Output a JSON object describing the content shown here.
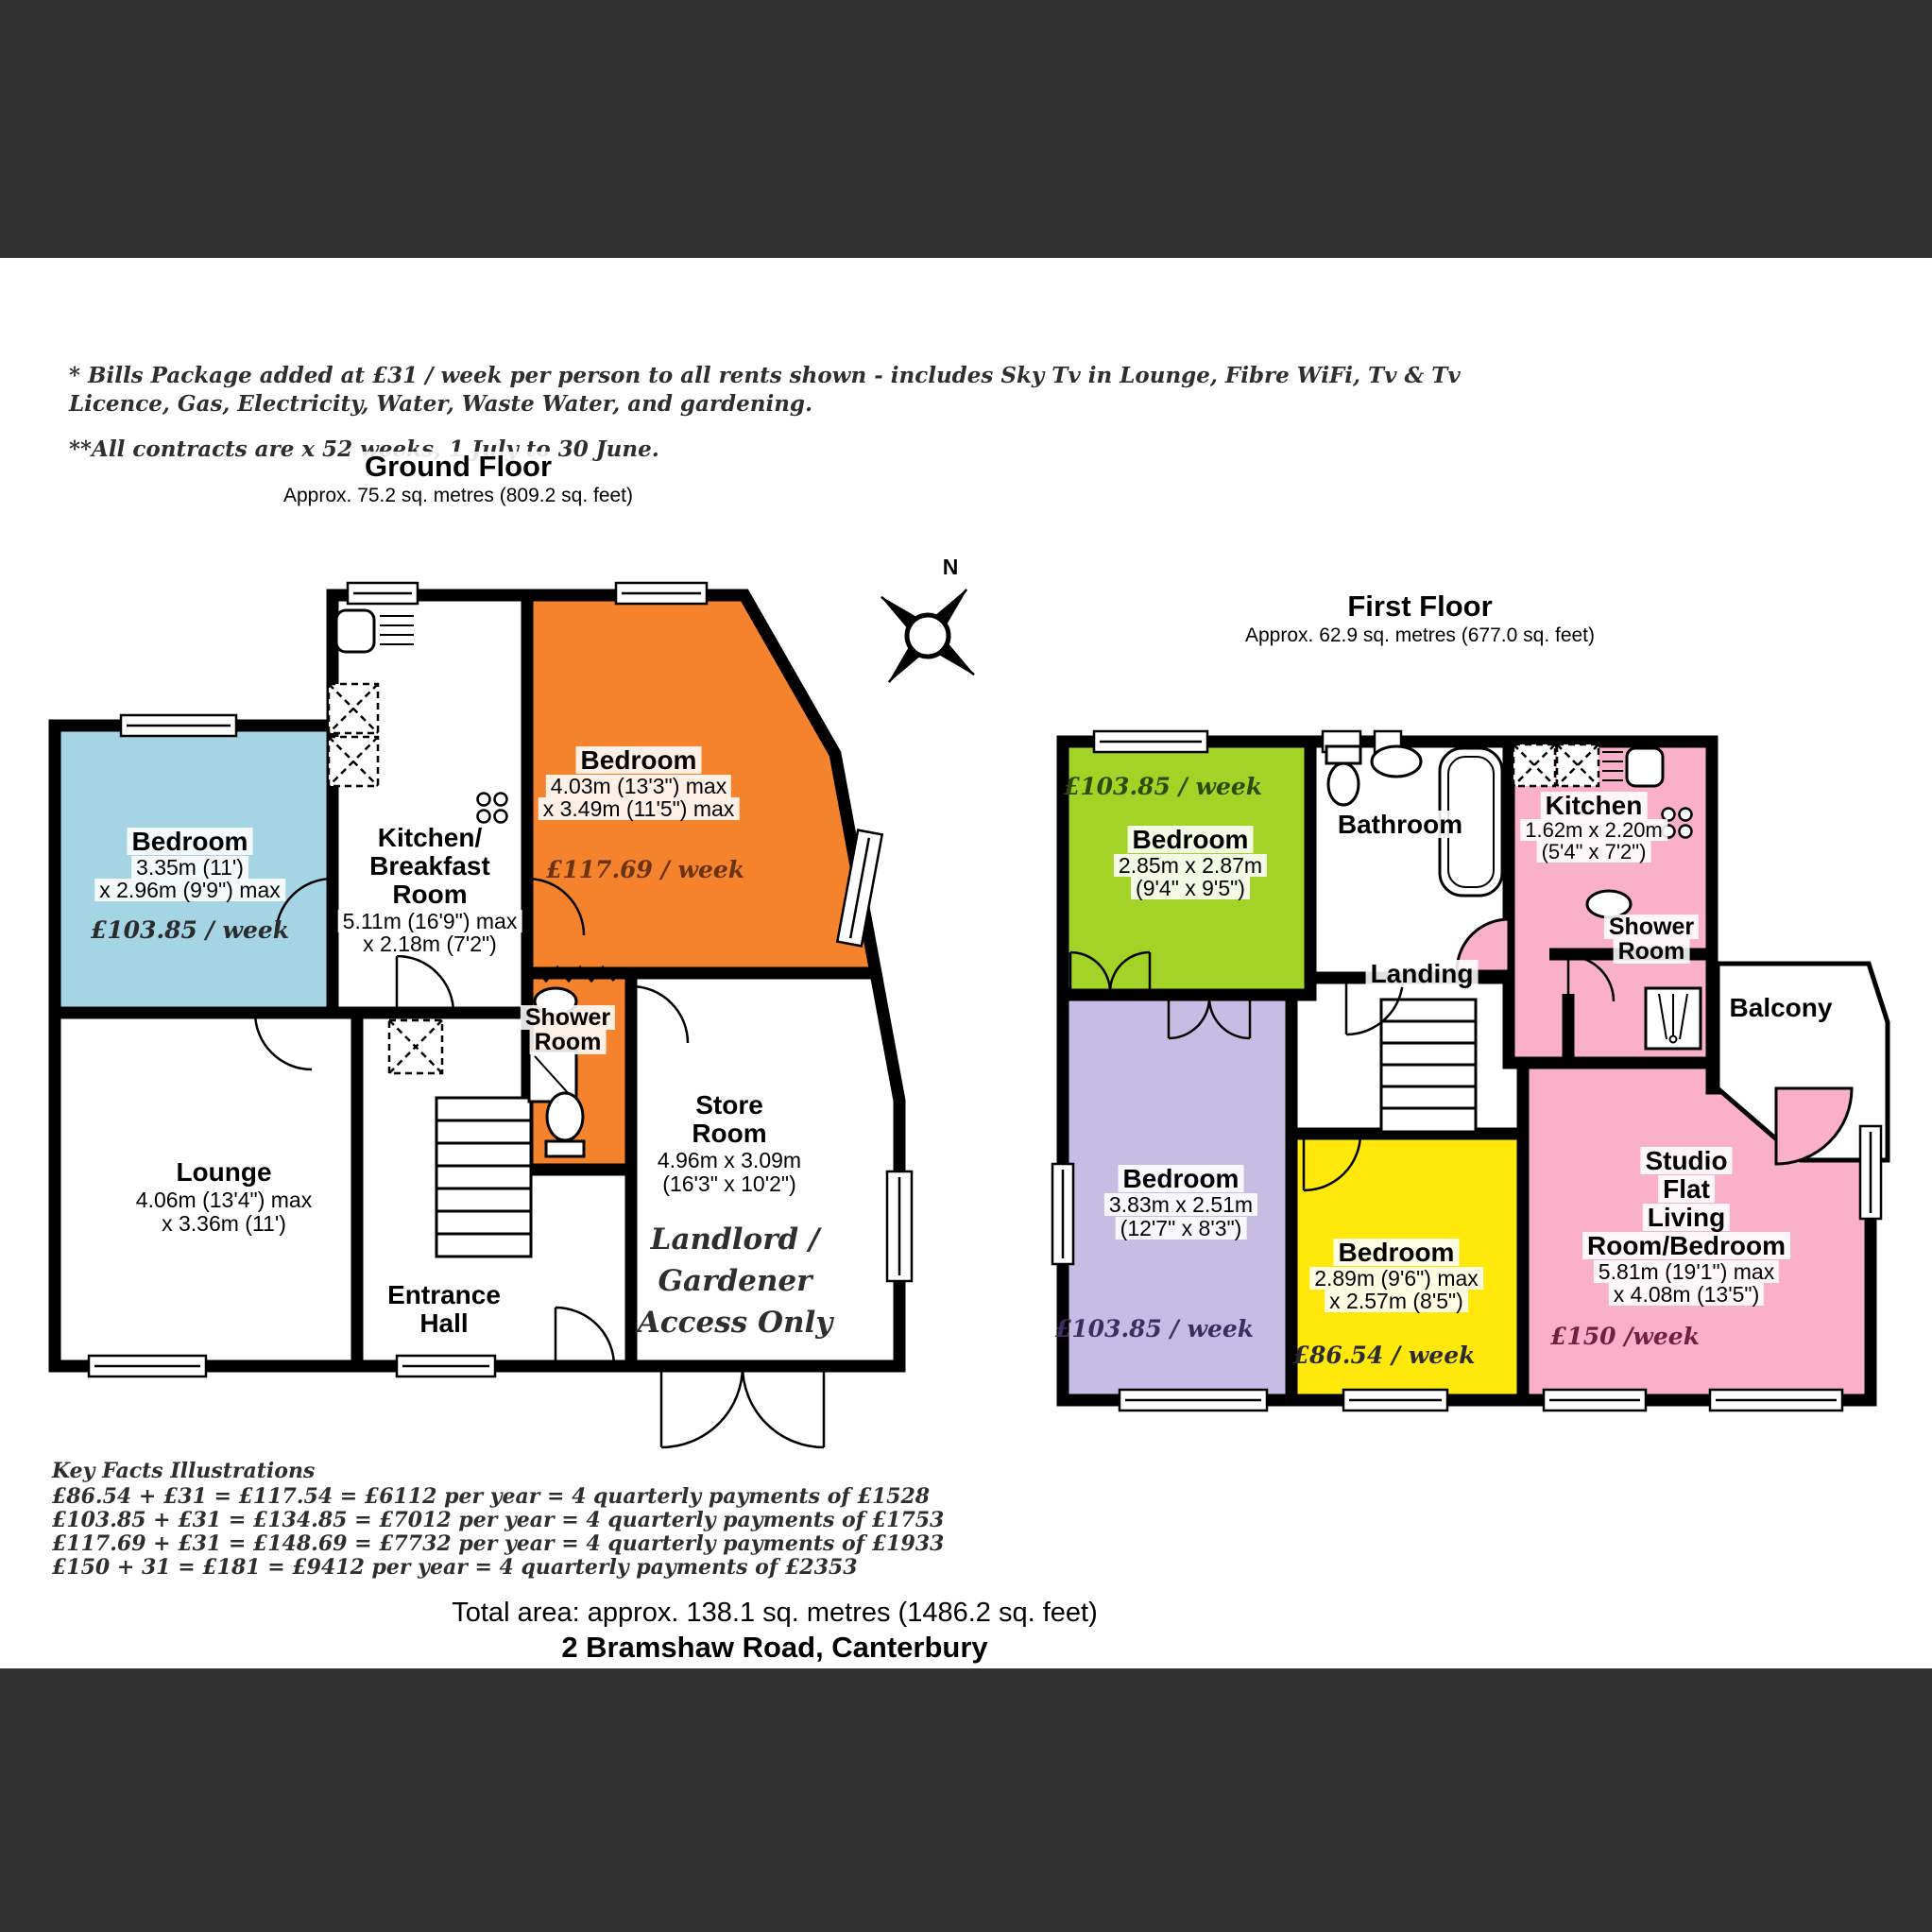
{
  "header": {
    "note1": "* Bills Package added at £31 / week per person to all rents shown - includes Sky Tv in Lounge, Fibre WiFi, Tv & Tv",
    "note2": "Licence, Gas, Electricity, Water, Waste Water, and gardening.",
    "note3": "**All contracts are x 52 weeks, 1 July to 30 June."
  },
  "compass": {
    "north_label": "N"
  },
  "ground_floor": {
    "title": "Ground Floor",
    "subtitle": "Approx. 75.2 sq. metres (809.2 sq. feet)",
    "rooms": {
      "bedroom_front": {
        "name": "Bedroom",
        "dim1": "3.35m (11')",
        "dim2": "x 2.96m (9'9\") max",
        "price": "£103.85 / week"
      },
      "kitchen": {
        "name1": "Kitchen/",
        "name2": "Breakfast",
        "name3": "Room",
        "dim1": "5.11m (16'9\") max",
        "dim2": "x 2.18m (7'2\")"
      },
      "bedroom_rear": {
        "name": "Bedroom",
        "dim1": "4.03m (13'3\") max",
        "dim2": "x 3.49m (11'5\") max",
        "price": "£117.69 / week"
      },
      "shower_room": {
        "name1": "Shower",
        "name2": "Room"
      },
      "store_room": {
        "name1": "Store",
        "name2": "Room",
        "dim1": "4.96m x 3.09m",
        "dim2": "(16'3\" x 10'2\")",
        "note1": "Landlord /",
        "note2": "Gardener",
        "note3": "Access Only"
      },
      "lounge": {
        "name": "Lounge",
        "dim1": "4.06m (13'4\") max",
        "dim2": "x 3.36m (11')"
      },
      "entrance_hall": {
        "name1": "Entrance",
        "name2": "Hall"
      }
    }
  },
  "first_floor": {
    "title": "First Floor",
    "subtitle": "Approx. 62.9 sq. metres (677.0 sq. feet)",
    "rooms": {
      "bedroom_green": {
        "price": "£103.85 / week",
        "name": "Bedroom",
        "dim1": "2.85m x 2.87m",
        "dim2": "(9'4\" x 9'5\")"
      },
      "bathroom": {
        "name": "Bathroom"
      },
      "kitchen": {
        "name": "Kitchen",
        "dim1": "1.62m x 2.20m",
        "dim2": "(5'4\" x 7'2\")"
      },
      "shower_room": {
        "name1": "Shower",
        "name2": "Room"
      },
      "balcony": {
        "name": "Balcony"
      },
      "landing": {
        "name": "Landing"
      },
      "bedroom_purple": {
        "name": "Bedroom",
        "dim1": "3.83m x 2.51m",
        "dim2": "(12'7\" x 8'3\")",
        "price": "£103.85 / week"
      },
      "bedroom_yellow": {
        "name": "Bedroom",
        "dim1": "2.89m (9'6\") max",
        "dim2": "x 2.57m (8'5\")",
        "price": "£86.54 / week"
      },
      "studio": {
        "name1": "Studio",
        "name2": "Flat",
        "name3": "Living",
        "name4": "Room/Bedroom",
        "dim1": "5.81m (19'1\") max",
        "dim2": "x 4.08m (13'5\")",
        "price": "£150 /week"
      }
    }
  },
  "key_facts": {
    "title": "Key Facts Illustrations",
    "lines": [
      "£86.54 + £31 = £117.54 = £6112 per year = 4 quarterly payments of £1528",
      "£103.85 + £31 = £134.85 = £7012 per year = 4 quarterly payments of £1753",
      "£117.69 + £31 = £148.69 = £7732 per year = 4 quarterly payments of £1933",
      "£150 + 31 = £181 = £9412 per year = 4 quarterly payments of £2353"
    ]
  },
  "footer": {
    "total_area": "Total area: approx. 138.1 sq. metres (1486.2 sq. feet)",
    "address": "2 Bramshaw Road, Canterbury"
  },
  "colors": {
    "band": "#323233",
    "wall": "#000000",
    "blue": "#A5D5E5",
    "orange": "#F5822D",
    "green": "#A4D327",
    "purple": "#C7BDE4",
    "yellow": "#FFE80A",
    "pink": "#F9B0C8"
  }
}
